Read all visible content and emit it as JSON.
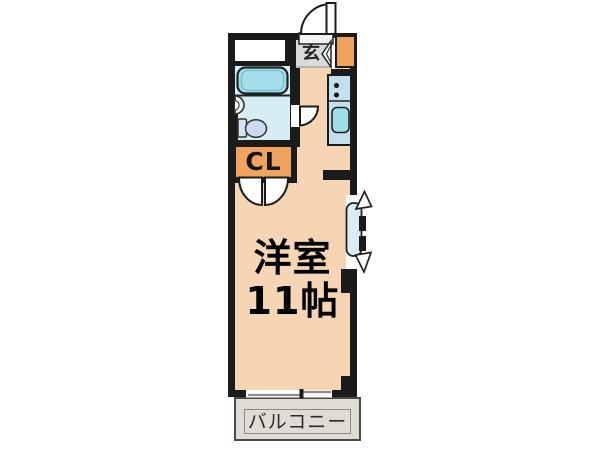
{
  "floorplan": {
    "labels": {
      "genkan": "玄",
      "closet": "CL",
      "room_name": "洋室",
      "room_size": "11帖",
      "balcony": "バルコニー"
    },
    "colors": {
      "background": "#ffffff",
      "wall": "#1b1b1b",
      "room_floor": "#f6d5b4",
      "bathroom_floor": "#d6edf4",
      "genkan_floor": "#d9d9d9",
      "balcony_floor": "#dfdcd6",
      "cabinet_orange": "#f0a35e",
      "kitchen_counter": "#c3e0ee",
      "bathtub": "#a6dfeb",
      "kitchen_sink": "#9fdde7",
      "window_pane": "#d9ecf7"
    },
    "fixtures": [
      "entrance-door",
      "shoe-cabinet",
      "bathtub",
      "washbasin",
      "toilet",
      "bath-door",
      "kitchen-counter",
      "stove-burners",
      "kitchen-sink",
      "closet-folding-doors",
      "bay-window",
      "sliding-window",
      "balcony"
    ]
  }
}
